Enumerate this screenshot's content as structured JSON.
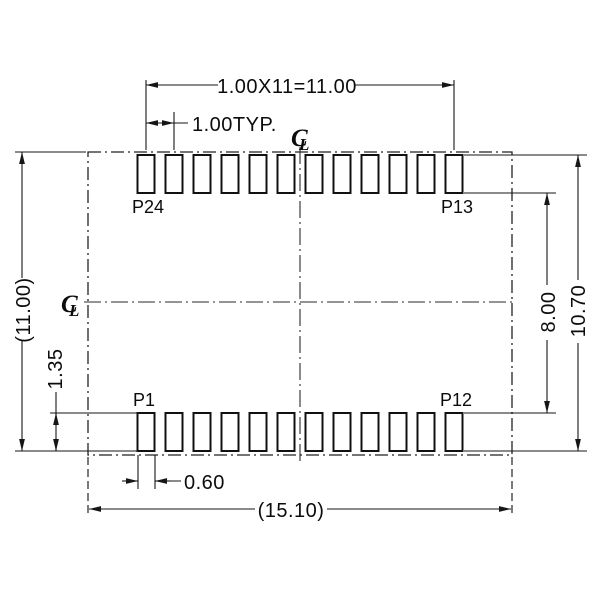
{
  "drawing": {
    "pads_per_row": 12,
    "pad_labels": {
      "top_left": "P24",
      "top_right": "P13",
      "bottom_left": "P1",
      "bottom_right": "P12"
    },
    "dimensions": {
      "pitch_total": "1.00X11=11.00",
      "pitch_typ": "1.00TYP.",
      "body_height_ref": "(11.00)",
      "pad_length": "1.35",
      "rows_inner_gap": "8.00",
      "rows_outer_span": "10.70",
      "pad_width": "0.60",
      "overall_width_ref": "(15.10)"
    },
    "centerline_symbol": {
      "c": "C",
      "l": "L"
    },
    "colors": {
      "ink": "#161616",
      "background": "#ffffff"
    }
  }
}
